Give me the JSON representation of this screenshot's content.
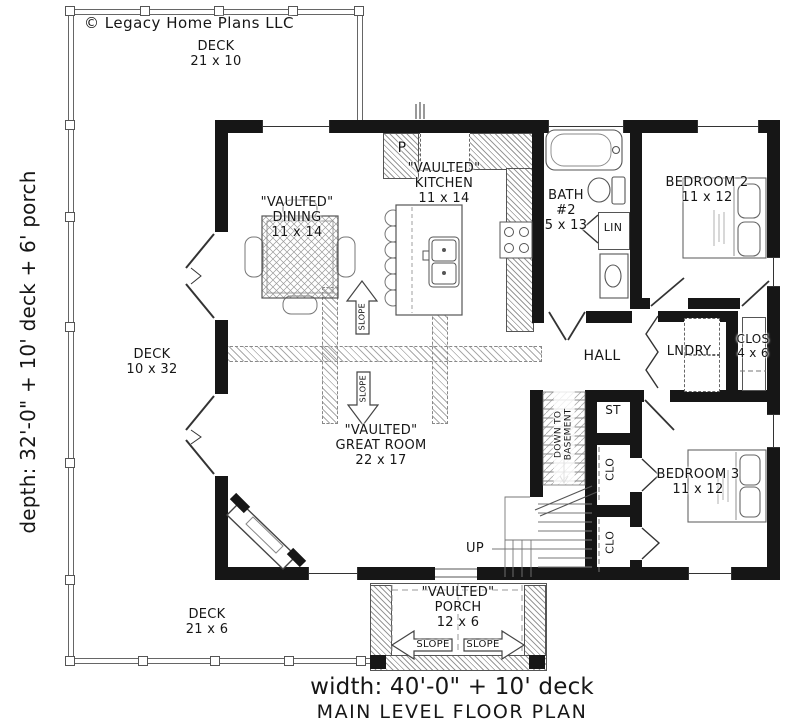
{
  "meta": {
    "copyright": "© Legacy Home Plans LLC",
    "plan_title": "MAIN LEVEL FLOOR PLAN",
    "width_label": "width: 40'-0\" + 10' deck",
    "depth_label": "depth: 32'-0\" + 10' deck + 6' porch",
    "ink_color": "#161616"
  },
  "rooms": {
    "deck_top": {
      "name": "DECK",
      "size": "21 x 10"
    },
    "deck_left": {
      "name": "DECK",
      "size": "10 x 32"
    },
    "deck_bottom": {
      "name": "DECK",
      "size": "21 x 6"
    },
    "dining": {
      "prefix": "\"VAULTED\"",
      "name": "DINING",
      "size": "11 x 14"
    },
    "kitchen": {
      "prefix": "\"VAULTED\"",
      "name": "KITCHEN",
      "size": "11 x 14"
    },
    "great_room": {
      "prefix": "\"VAULTED\"",
      "name": "GREAT ROOM",
      "size": "22 x 17"
    },
    "porch": {
      "prefix": "\"VAULTED\"",
      "name": "PORCH",
      "size": "12 x 6"
    },
    "bath2": {
      "name": "BATH",
      "number": "#2",
      "size": "5 x 13"
    },
    "bedroom2": {
      "name": "BEDROOM 2",
      "size": "11 x 12"
    },
    "bedroom3": {
      "name": "BEDROOM 3",
      "size": "11 x 12"
    },
    "closet": {
      "name": "CLOS",
      "size": "4 x 6"
    },
    "hall": {
      "name": "HALL"
    },
    "laundry": {
      "name": "LNDRY"
    }
  },
  "labels": {
    "pantry": "P",
    "linen": "LIN",
    "storage": "ST",
    "closet_small": "CLO",
    "stairs_up": "UP",
    "down_line1": "DOWN TO",
    "down_line2": "BASEMENT",
    "slope": "SLOPE"
  }
}
